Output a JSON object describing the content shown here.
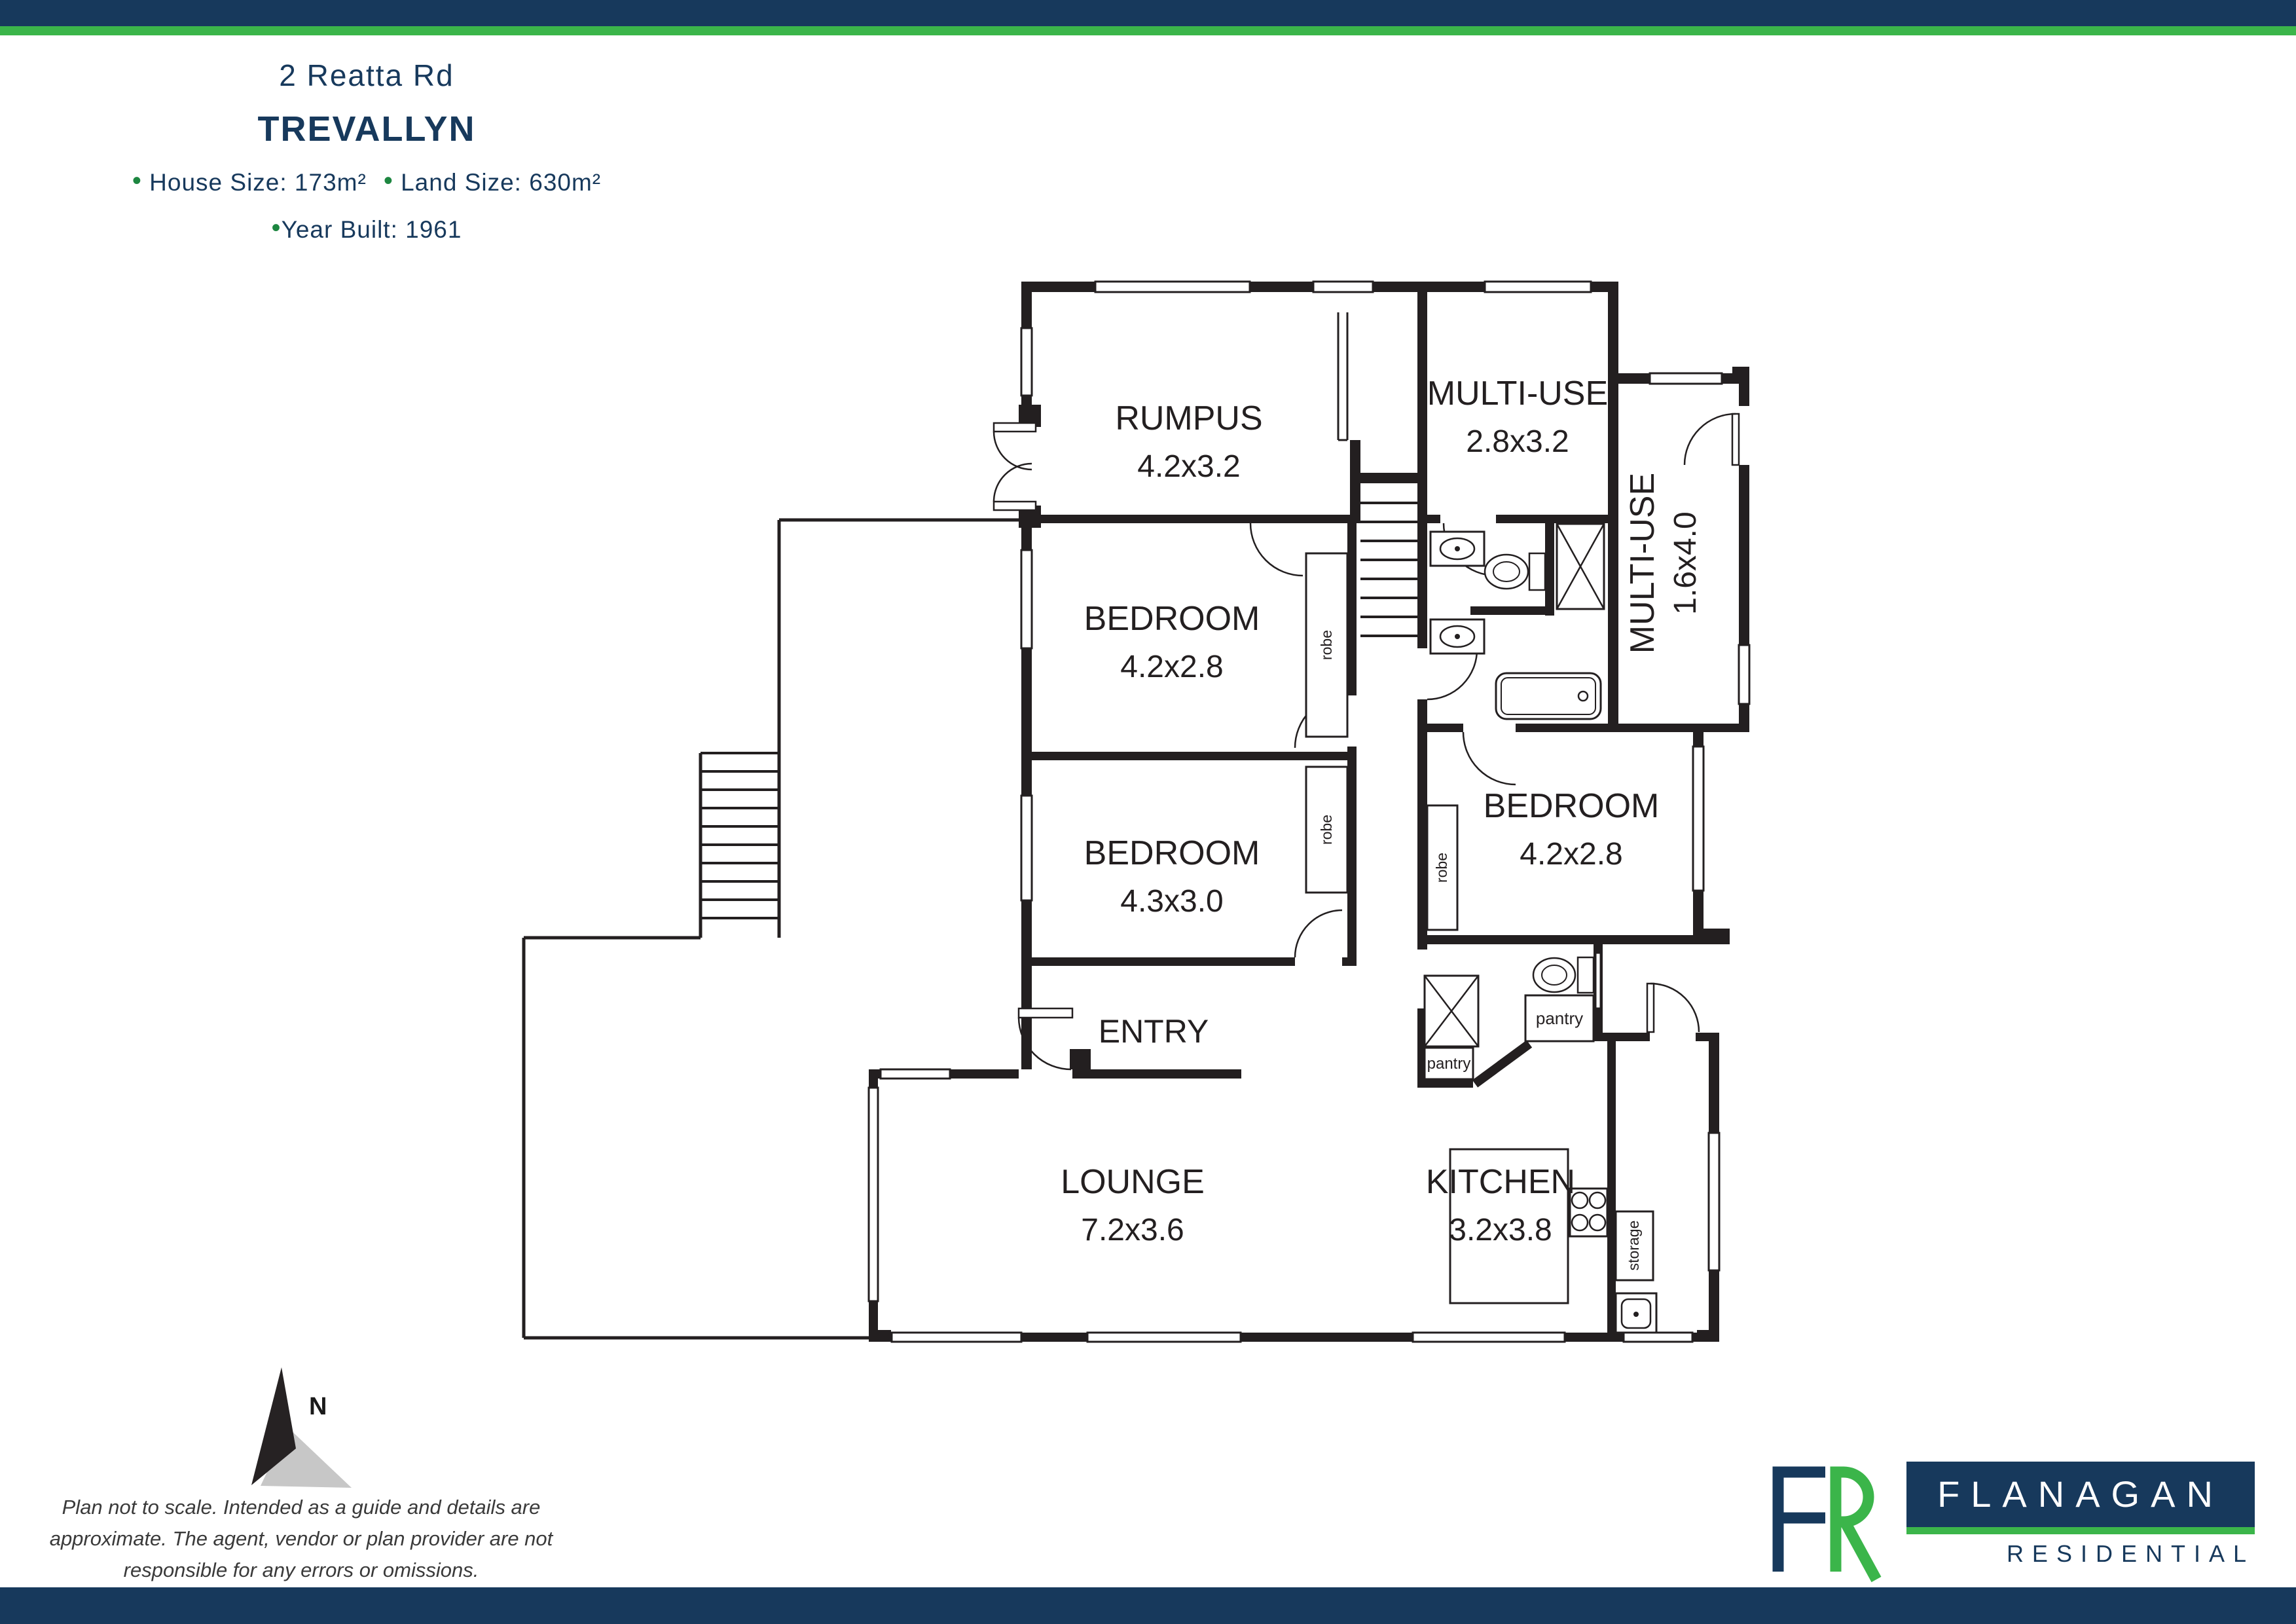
{
  "colors": {
    "navy": "#17395c",
    "green": "#3bb54a",
    "bullet_green": "#1d8640",
    "ink": "#231f20",
    "compass_gray": "#c7c7c7"
  },
  "header": {
    "address": "2 Reatta Rd",
    "suburb": "TREVALLYN",
    "bullet": "•",
    "house_size": "House Size: 173m²",
    "land_size": "Land Size: 630m²",
    "year_built": "Year Built: 1961"
  },
  "plan": {
    "rooms": [
      {
        "name": "RUMPUS",
        "dims": "4.2x3.2"
      },
      {
        "name": "MULTI-USE",
        "dims": "2.8x3.2"
      },
      {
        "name": "MULTI-USE",
        "dims": "1.6x4.0"
      },
      {
        "name": "BEDROOM",
        "dims": "4.2x2.8"
      },
      {
        "name": "BEDROOM",
        "dims": "4.3x3.0"
      },
      {
        "name": "BEDROOM",
        "dims": "4.2x2.8"
      },
      {
        "name": "ENTRY",
        "dims": ""
      },
      {
        "name": "LOUNGE",
        "dims": "7.2x3.6"
      },
      {
        "name": "KITCHEN",
        "dims": "3.2x3.8"
      }
    ],
    "labels": {
      "robe": "robe",
      "pantry": "pantry",
      "storage": "storage"
    },
    "compass": "N"
  },
  "footer": {
    "disclaimer": [
      "Plan not to scale. Intended as a guide and details are",
      "approximate. The agent, vendor or plan provider are not",
      "responsible for any errors or omissions."
    ],
    "logo": {
      "name": "FLANAGAN",
      "tagline": "RESIDENTIAL"
    }
  }
}
